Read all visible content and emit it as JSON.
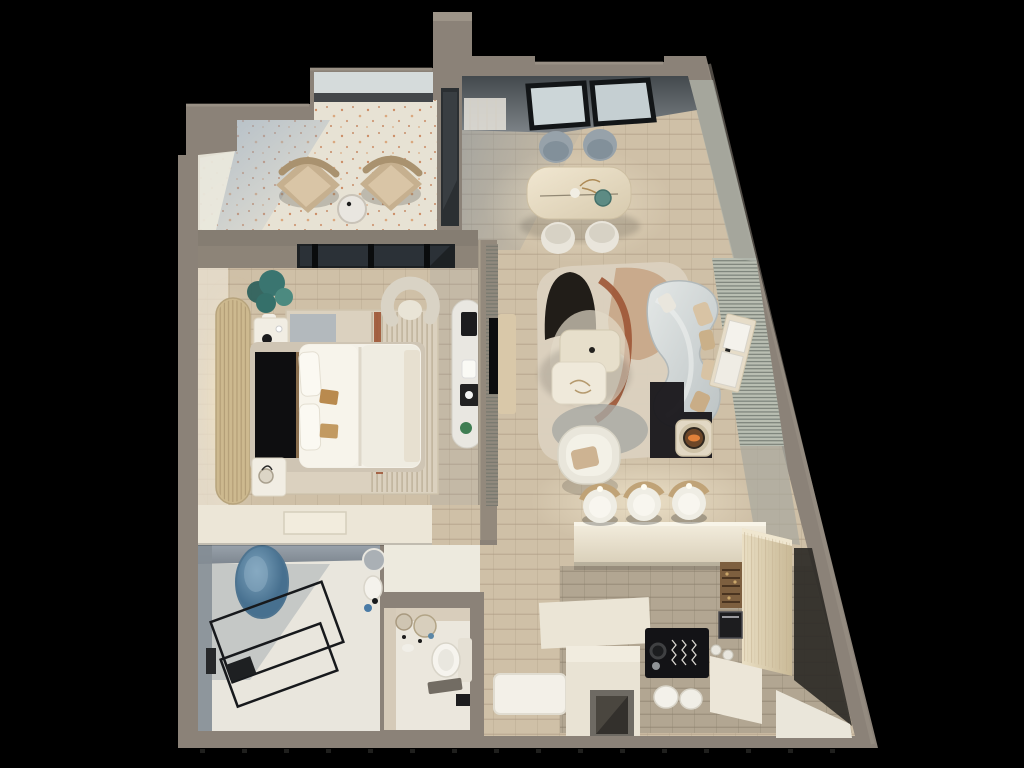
{
  "scene": {
    "type": "3d-rendered-floor-plan",
    "description": "Top-down 3D render of a one-bedroom apartment with a slanted right exterior wall, shown on a black background. No text is rendered in the image.",
    "view": "axonometric top-down",
    "rooms": [
      {
        "id": "balcony",
        "furniture": [
          "armchair",
          "armchair",
          "round-side-table"
        ]
      },
      {
        "id": "dining",
        "furniture": [
          "dining-table",
          "gray-chair",
          "gray-chair",
          "white-chair",
          "white-chair",
          "window-wall"
        ]
      },
      {
        "id": "bedroom",
        "furniture": [
          "double-bed",
          "black-headboard",
          "nightstand",
          "nightstand",
          "slatted-headboard-panel",
          "plant",
          "area-rug",
          "vanity-desk",
          "curved-accent-chair",
          "wardrobe-counter",
          "window-band"
        ]
      },
      {
        "id": "living",
        "furniture": [
          "curved-sofa",
          "throw-pillows",
          "coffee-table",
          "coffee-table",
          "lounge-chair",
          "fire-bowl-table",
          "tv-panel",
          "tv-console",
          "ribbed-wall-panel",
          "sideboard-with-art",
          "abstract-rug"
        ]
      },
      {
        "id": "kitchen",
        "furniture": [
          "bar-counter",
          "bar-stool",
          "bar-stool",
          "bar-stool",
          "black-cooktop-counter",
          "white-canisters",
          "tall-pantry",
          "wine-rack",
          "oven"
        ]
      },
      {
        "id": "bathroom",
        "furniture": [
          "glass-shower",
          "blue-mosaic-oval",
          "washbasin",
          "round-mirror"
        ]
      },
      {
        "id": "toilet",
        "furniture": [
          "wall-hung-toilet",
          "washbasin",
          "round-mirror",
          "round-mirror",
          "black-towel-box"
        ]
      },
      {
        "id": "entry",
        "furniture": [
          "white-doormat",
          "closet-block",
          "door-niche"
        ]
      }
    ]
  },
  "palette": {
    "background": "#000000",
    "wall": "#8b8278",
    "wall_top": "#a39a8d",
    "wall_dark": "#6f675d",
    "wall_face_light": "#b2ada0",
    "terrazzo": "#e7e2d4",
    "terrazzo_speckle": "#c5794d",
    "wood": "#cfc0a7",
    "wood_line": "#a8977e",
    "wood_gray": "#b2a692",
    "floor_white": "#ece8dc",
    "bath_wall": "#8f98a1",
    "blue_accent": "#5f88a6",
    "glass": "#d5dbdb",
    "glass_dark": "#2b2f32",
    "frame_black": "#17191c",
    "ceiling_band": "#565c60",
    "sofa": "#d5dad9",
    "cushion_tan": "#c7ac8b",
    "rug_base": "#dbd1bf",
    "rug_tan": "#c6a384",
    "rug_rust": "#9d5535",
    "rug_black": "#211d18",
    "rug_gray": "#a7a9a4",
    "table_wood": "#e7ddc6",
    "chair_gray": "#97a2aa",
    "chair_white": "#e9e5db",
    "duvet": "#f4f1e8",
    "headboard_black": "#0e0e10",
    "slat_wood": "#cdb98f",
    "glow_warm": "#f7e6bf",
    "plant_teal": "#3a7570",
    "fire_orange": "#e0813a",
    "counter_cream": "#ece5d4",
    "cooktop_black": "#131316",
    "pantry_wood": "#e2d5b8",
    "stool_brass": "#c0a377",
    "beige_wall": "#d3c8b6",
    "rib_panel": "#b9beb2",
    "rib_line": "#5f665f",
    "mat_white": "#f3f0e8",
    "niche_dark": "#33302c"
  }
}
